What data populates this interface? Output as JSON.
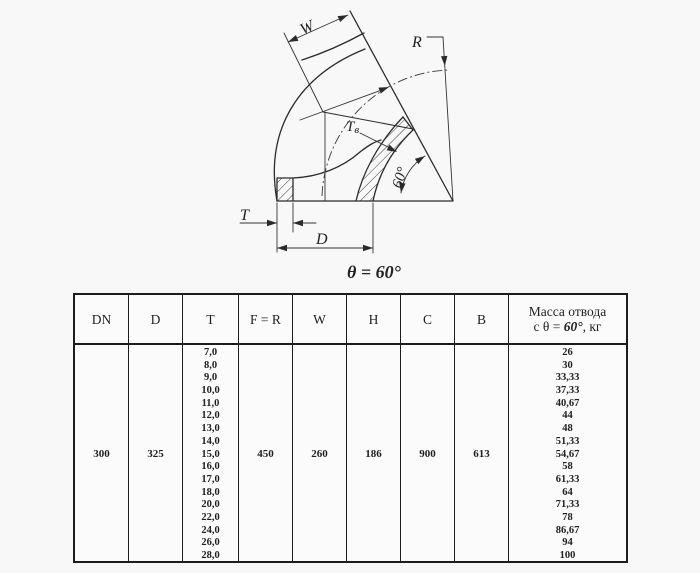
{
  "colors": {
    "ink": "#2b2b2b",
    "background": "#f8f8f8",
    "table_border": "#1c1c1c"
  },
  "drawing": {
    "labels": {
      "w": "W",
      "r": "R",
      "tv_main": "T",
      "tv_sub": "в",
      "angle": "60°",
      "t": "T",
      "d": "D",
      "caption": "θ = 60°"
    }
  },
  "table": {
    "headers": [
      "DN",
      "D",
      "T",
      "F = R",
      "W",
      "H",
      "C",
      "B"
    ],
    "mass_header": {
      "line1": "Масса отвода",
      "line2_prefix": "с θ = ",
      "line2_value": "60°",
      "line2_suffix": ", кг"
    },
    "row": {
      "dn": "300",
      "d": "325",
      "t_values": [
        "7,0",
        "8,0",
        "9,0",
        "10,0",
        "11,0",
        "12,0",
        "13,0",
        "14,0",
        "15,0",
        "16,0",
        "17,0",
        "18,0",
        "20,0",
        "22,0",
        "24,0",
        "26,0",
        "28,0"
      ],
      "f_r": "450",
      "w": "260",
      "h": "186",
      "c": "900",
      "b": "613",
      "mass_values": [
        "26",
        "30",
        "33,33",
        "37,33",
        "40,67",
        "44",
        "48",
        "51,33",
        "54,67",
        "58",
        "61,33",
        "64",
        "71,33",
        "78",
        "86,67",
        "94",
        "100"
      ]
    }
  }
}
